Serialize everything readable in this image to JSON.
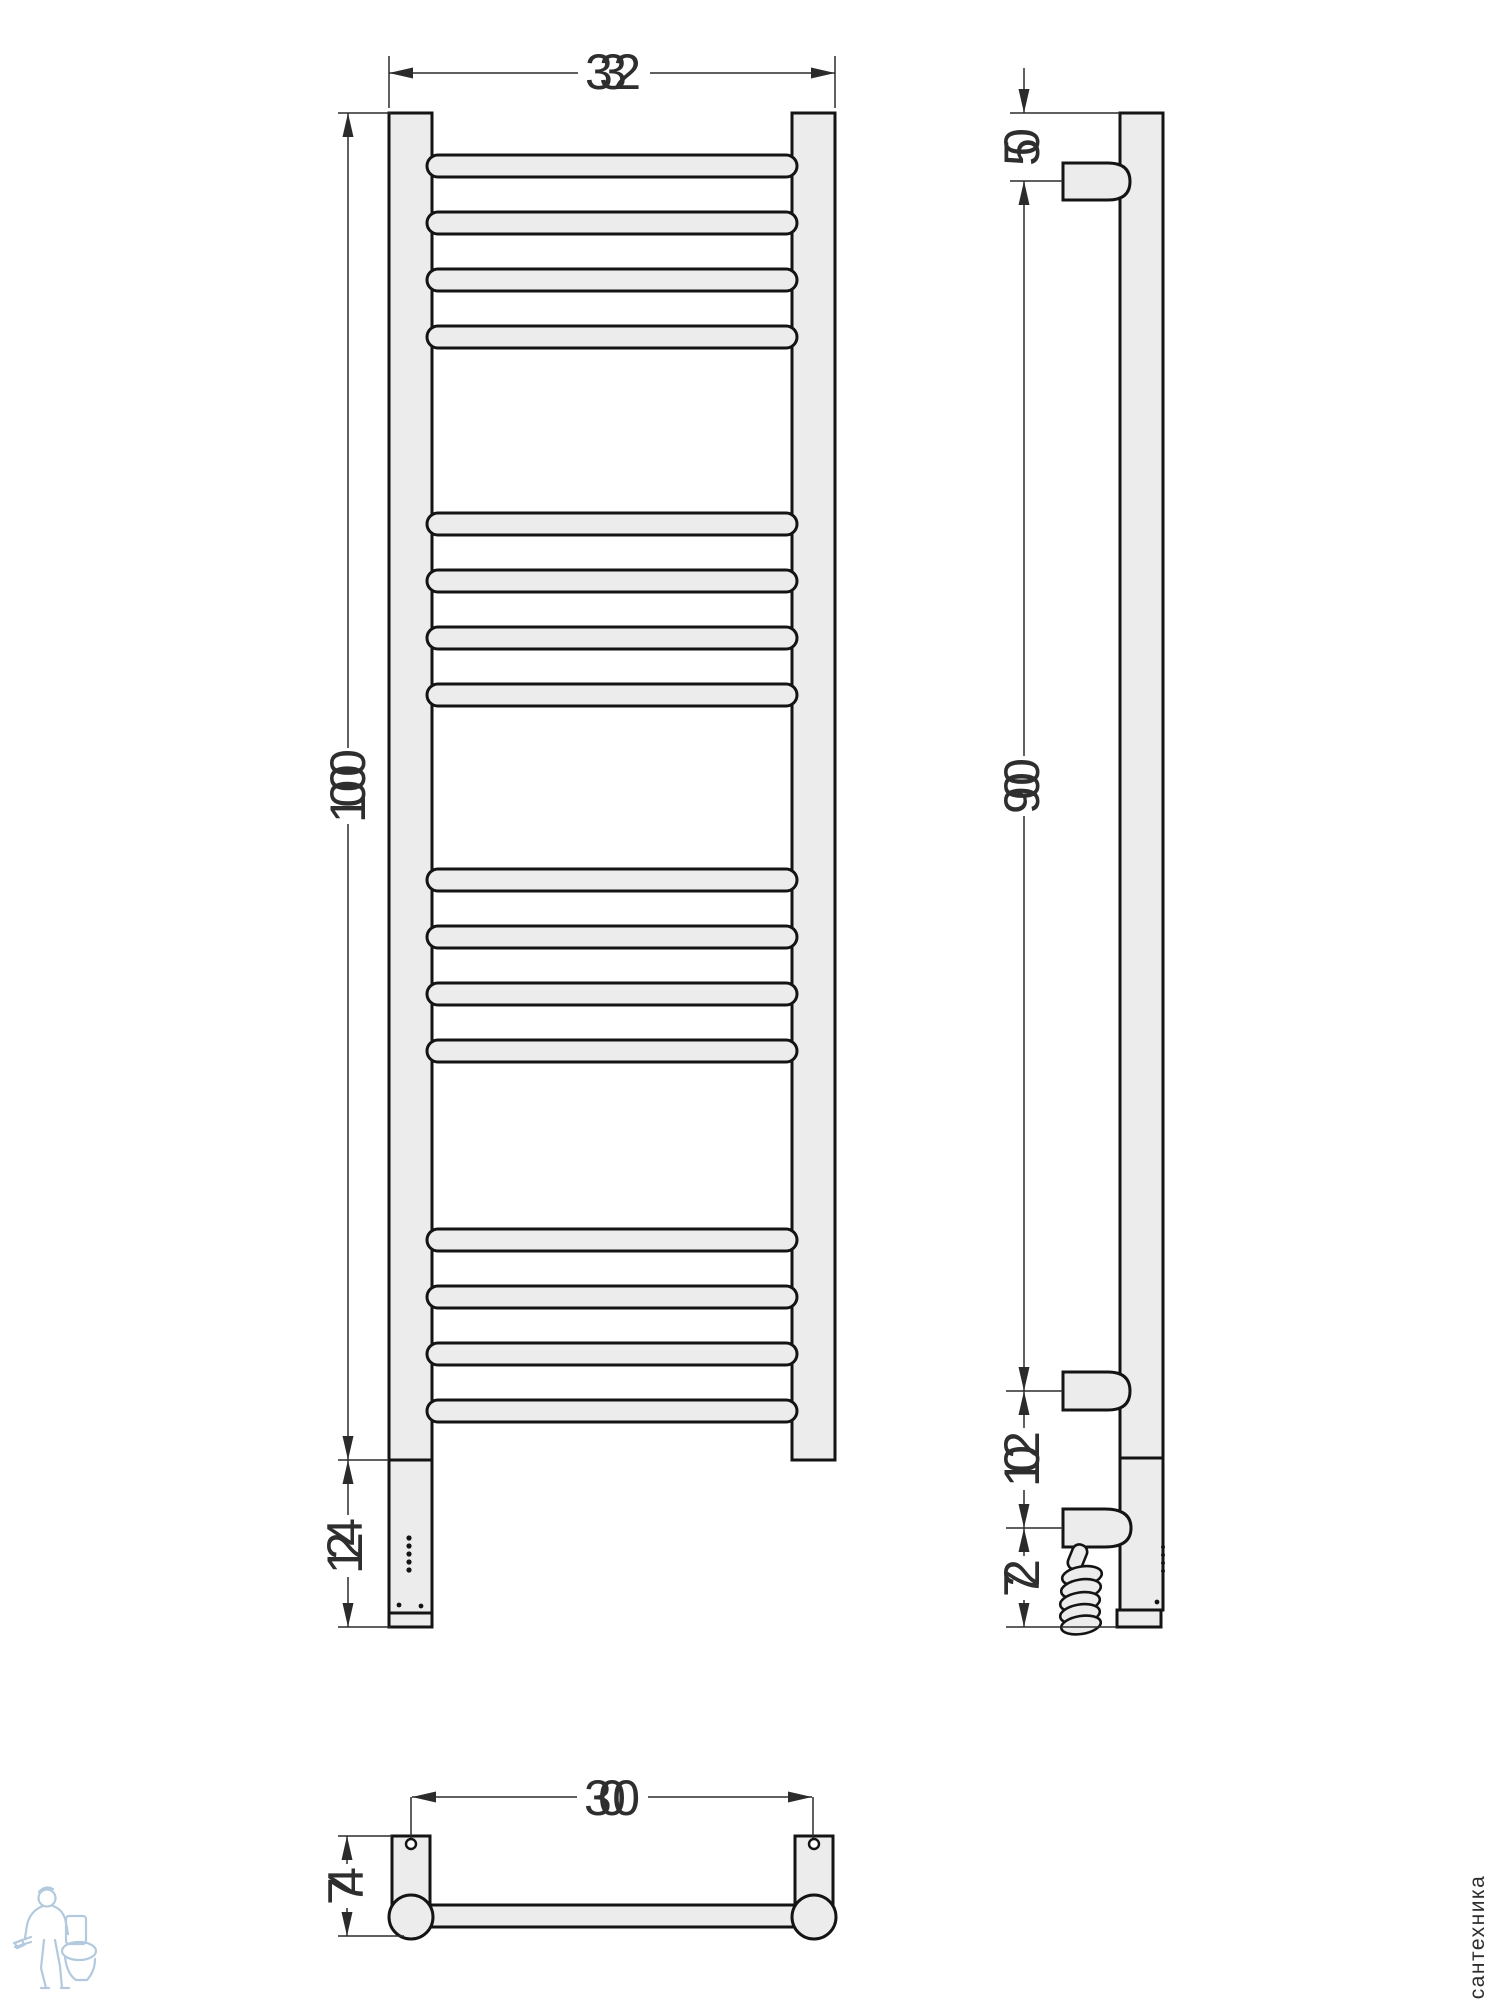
{
  "drawing": {
    "type": "technical-dimension-drawing",
    "subject": "ladder towel rail radiator, front / side / bottom views",
    "dimensions": {
      "front_width": "332",
      "front_height": "1000",
      "heater_section_height": "124",
      "side_top_offset": "50",
      "side_bracket_span": "900",
      "side_bracket_to_socket": "102",
      "side_socket_to_bottom": "72",
      "bottom_mount_width": "300",
      "bottom_depth": "74"
    },
    "watermark": {
      "vertical_text": "сантехника",
      "logo": "plumber-with-toilet-logo"
    },
    "colors": {
      "body_fill": "#ececec",
      "outline": "#141414",
      "dimension_line": "#2b2b2b",
      "logo_stroke": "#abc4db",
      "watermark_text": "#e1e1e1"
    }
  }
}
